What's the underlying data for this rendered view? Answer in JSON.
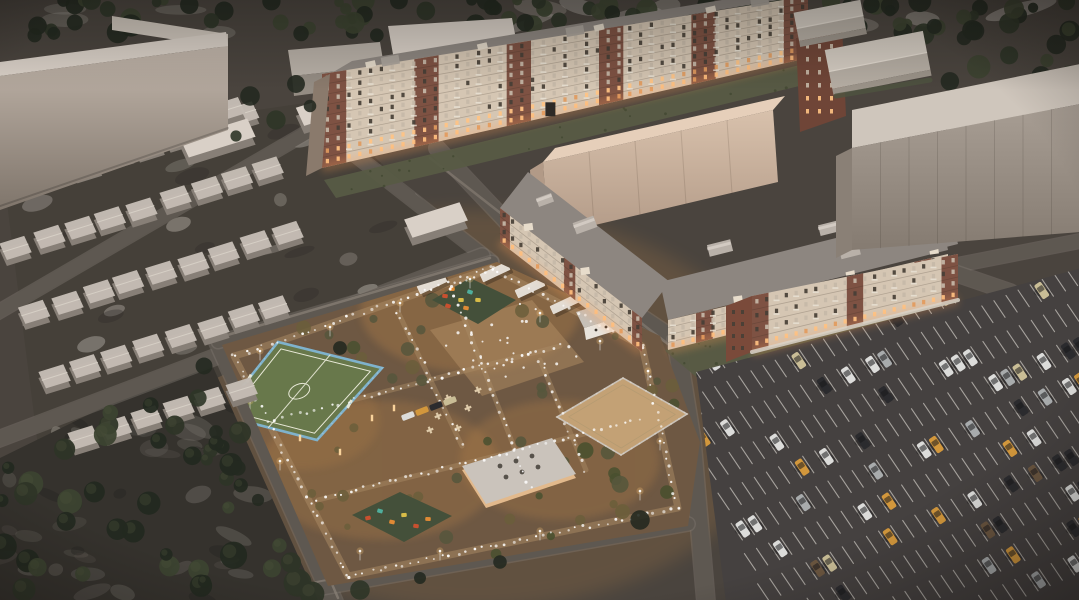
{
  "canvas": {
    "width": 1079,
    "height": 600
  },
  "scene": {
    "title": "residential-complex-aerial-render",
    "time_of_day": "dusk",
    "elements": {
      "tree_line_north": {
        "label": "dense dark tree belt along the top edge"
      },
      "northwest_warehouse": {
        "label": "large light L-shaped industrial block, top left"
      },
      "garage_compound": {
        "label": "rows of small gabled garages on a mottled gravel lot"
      },
      "north_apartment_building": {
        "label": "long 9-story apartment block, brick and cream bays, lit lower floors",
        "floors": 9
      },
      "rear_block": {
        "label": "tall plain cream building behind mid block"
      },
      "mid_apartment_building": {
        "label": "5-story L-shaped apartment block around courtyard",
        "floors": 5
      },
      "east_apartment_building": {
        "label": "4-story apartment block beside parking",
        "floors": 4
      },
      "east_warehouse": {
        "label": "long windowless warehouse on the right"
      },
      "northeast_sheds": {
        "label": "gabled warehouse sheds among trees, top right"
      },
      "courtyard": {
        "label": "warm-lit landscaped courtyard with paths, lamps and shrubs"
      },
      "soccer_field": {
        "label": "blue-fenced green mini football pitch with white markings"
      },
      "sand_court": {
        "label": "fenced sand sports court"
      },
      "playgrounds": {
        "label": "two playgrounds with colorful equipment",
        "count": 2
      },
      "utility_building": {
        "label": "flat-roof service building with roof vents"
      },
      "guard_house": {
        "label": "small white gatehouse"
      },
      "pergolas": {
        "label": "white canopy pergolas",
        "count": 4
      },
      "parking_lot": {
        "label": "large marked parking lot with scattered cars"
      },
      "forest_southwest": {
        "label": "dark tree grove, bottom left"
      }
    }
  },
  "colors": {
    "ground": "#4a443e",
    "road": "#5e5851",
    "road_edge": "#837b72",
    "sidewalk": "#8a8177",
    "tree_dark": "#232920",
    "tree_mid": "#2e3527",
    "tree_olive": "#3c4330",
    "snow_patch": "#b5aea7",
    "swirl": "#7a756e",
    "garage_ground": "#454039",
    "garage_roof": "#c3bbb2",
    "garage_side": "#877f77",
    "garage_ridge": "#d8d1c8",
    "warehouse_face_top": "#c2b6ab",
    "warehouse_face_bottom": "#7f756b",
    "warehouse_roof": "#d9d0c7",
    "brick": "#7e5243",
    "brick_dark": "#6f4537",
    "cream": "#d5c6b3",
    "cream_bright": "#e7dccb",
    "roof_gray": "#8d8680",
    "block_face": "#d8c1ac",
    "block_face_dark": "#b29a87",
    "block_roof": "#e6cfba",
    "east_wh_face": "#a89e94",
    "east_wh_face_dark": "#857b71",
    "east_wh_roof": "#cfc6bc",
    "lawn": "#575b45",
    "lawn_dark": "#3f462f",
    "hedge": "#4e5440",
    "yard_ground": "#6e5843",
    "yard_glow": "#c08749",
    "path": "#ab8b66",
    "plaza": "#b28d63",
    "shrub1": "#56563c",
    "shrub2": "#49502f",
    "shrub3": "#6b5e3b",
    "pitch": "#68784b",
    "pitch_line": "#e9e9d8",
    "fence_blue": "#7fb2cc",
    "sand": "#c3a175",
    "fence_light": "#cac2b8",
    "rubber": "#44503a",
    "play_red": "#c8502f",
    "play_orange": "#e08a35",
    "play_yellow": "#d8bc48",
    "play_teal": "#4fae9d",
    "white_struct": "#e8e3db",
    "struct_roof": "#c6c0b8",
    "asphalt": "#454140",
    "stall_line": "#ccc7c0",
    "window_dark": "#463f36",
    "window_pale": "#c6b9a8",
    "window_lit": "#ffc384",
    "glow_warm": "#ff9e54",
    "lamp_glow": "#ffca7a",
    "light_dot": "#ffffff"
  },
  "render": {
    "seed": 42,
    "parking": {
      "rows": 12,
      "stalls_per_row": 34,
      "car_probability": 0.17,
      "car_probability_east": 0.3,
      "car_colors": [
        "#dcdcda",
        "#2b2b2e",
        "#a8abac",
        "#d2973c",
        "#c9bd96",
        "#6b5640"
      ],
      "car_color_weights": [
        0.33,
        0.22,
        0.15,
        0.13,
        0.09,
        0.08
      ]
    },
    "courtyard_lights": {
      "count_per_8px": 1,
      "plaza_extra": 26,
      "lamp_posts": 14
    },
    "garages": {
      "rows": 6,
      "per_row_max": 9
    },
    "trees": {
      "north_band": 85,
      "northeast": 30,
      "southwest": 44
    }
  }
}
